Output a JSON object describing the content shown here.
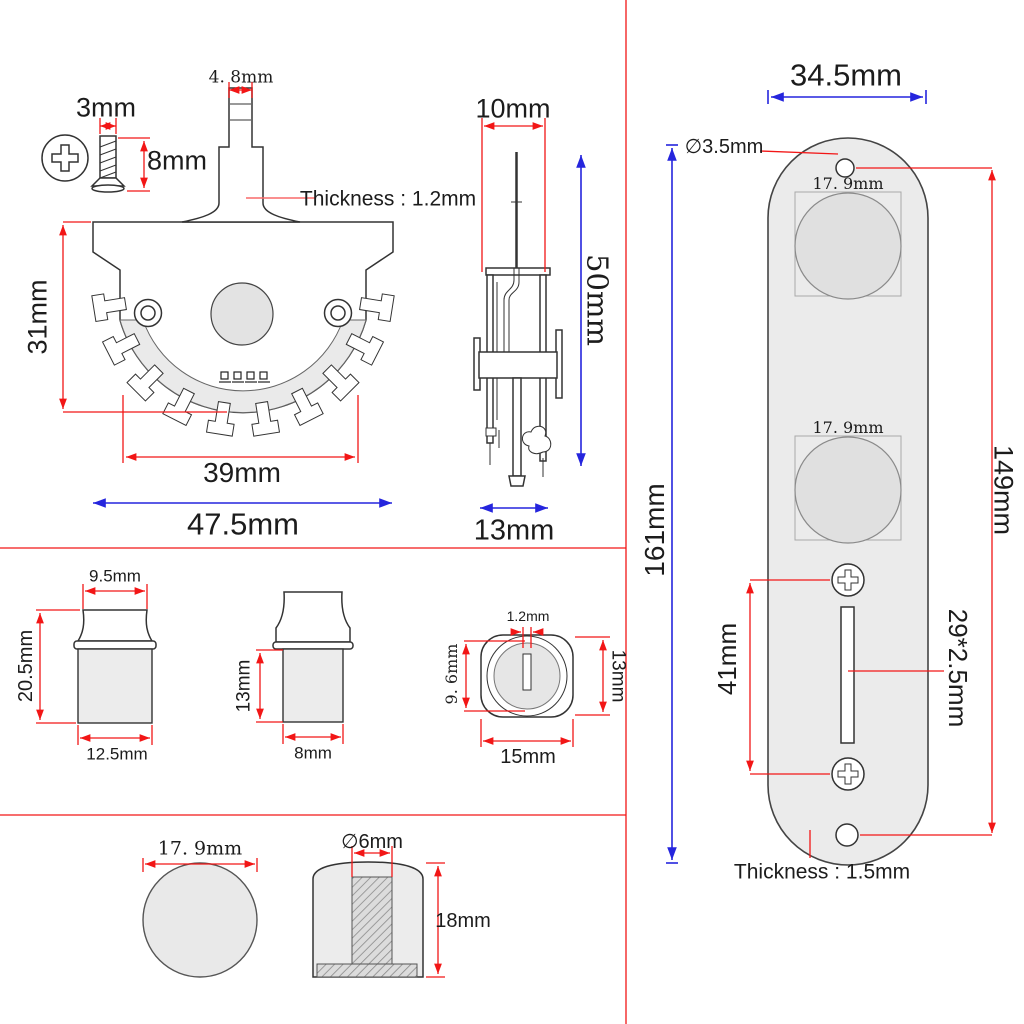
{
  "drawing_title": "guitar-switch-and-control-plate-dimension-diagram",
  "colors": {
    "dim_red": "#f21616",
    "dim_blue": "#2525dd",
    "line": "#333333",
    "fill_gray": "#ebebeb"
  },
  "labels": {
    "screw": {
      "diameter": "3mm",
      "length": "8mm"
    },
    "switch_front": {
      "tip_width": "4. 8mm",
      "thickness": "Thickness : 1.2mm",
      "height": "31mm",
      "lug_arc_width": "39mm",
      "total_width": "47.5mm"
    },
    "switch_side": {
      "width": "10mm",
      "height": "50mm",
      "depth": "13mm"
    },
    "knob_large": {
      "top_width": "9.5mm",
      "height": "20.5mm",
      "base_width": "12.5mm"
    },
    "knob_small": {
      "height": "13mm",
      "base_width": "8mm"
    },
    "tip_top": {
      "slot_width": "1.2mm",
      "inner_diameter": "9. 6mm",
      "height": "13mm",
      "width": "15mm"
    },
    "knob_face": {
      "diameter": "17. 9mm"
    },
    "knob_section": {
      "bore": "∅6mm",
      "height": "18mm"
    },
    "plate": {
      "width": "34.5mm",
      "mount_hole": "∅3.5mm",
      "knob1": "17. 9mm",
      "knob2": "17. 9mm",
      "length": "161mm",
      "hole_span": "149mm",
      "screw_span": "41mm",
      "slot": "29*2.5mm",
      "thickness": "Thickness : 1.5mm"
    }
  }
}
